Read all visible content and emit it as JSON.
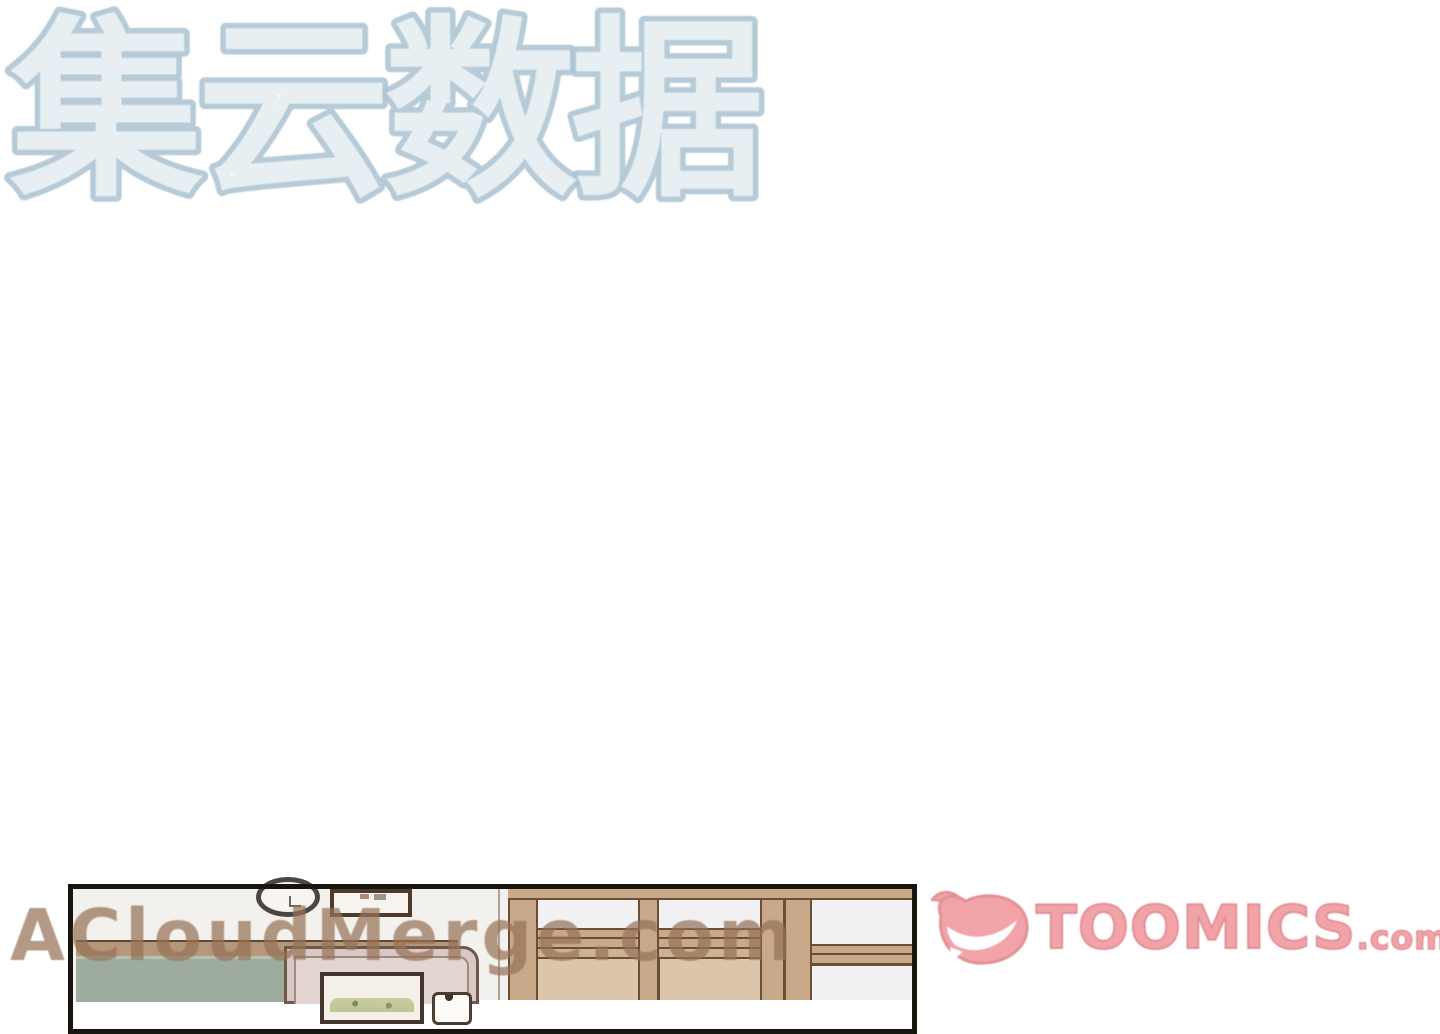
{
  "page": {
    "background_color": "#ffffff",
    "description": "Mostly blank webtoon reader page with a partially visible comic panel at the bottom"
  },
  "watermarks": {
    "cjk": {
      "text": "集云数据",
      "outline_color": "#aec5d3",
      "fill_color": "#f3f8fa"
    },
    "site": {
      "text": "ACloudMerge.com",
      "color": "#97755a"
    }
  },
  "brand_logo": {
    "name": "TOOMICS",
    "suffix": ".com",
    "fill_color": "#f0949a",
    "outline_color": "#de7e85",
    "mascot": "toomics-grin-mascot"
  },
  "comic_panel": {
    "border_color": "#18150f",
    "wall_color": "#f3f1ed",
    "chalkboard_color": "#9dac9d",
    "trim_color": "#b5977b",
    "pink_door_color": "#d9c8c5",
    "wood_mullion_color": "#c8aa8b",
    "wood_panel_color": "#dcc6aa",
    "window_pane_color": "#f1f1f4",
    "line_color": "#6b4e36",
    "objects": [
      "wall-clock",
      "small-picture-frame",
      "chalkboard",
      "pink-door-with-framed-picture",
      "light-switch",
      "sliding-wood-door-with-glass-panes"
    ]
  }
}
